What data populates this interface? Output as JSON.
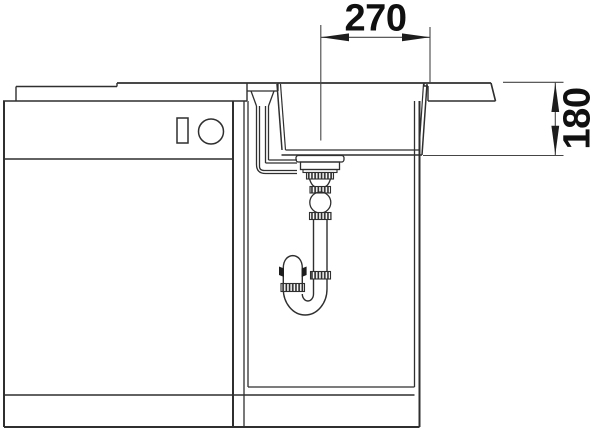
{
  "drawing": {
    "background_color": "#ffffff",
    "line_color": "#2f2f2f",
    "dimension_line_color": "#454545",
    "dimension_text_color": "#101010",
    "dimensions": {
      "horizontal": {
        "label": "270"
      },
      "vertical": {
        "label": "180"
      }
    }
  }
}
